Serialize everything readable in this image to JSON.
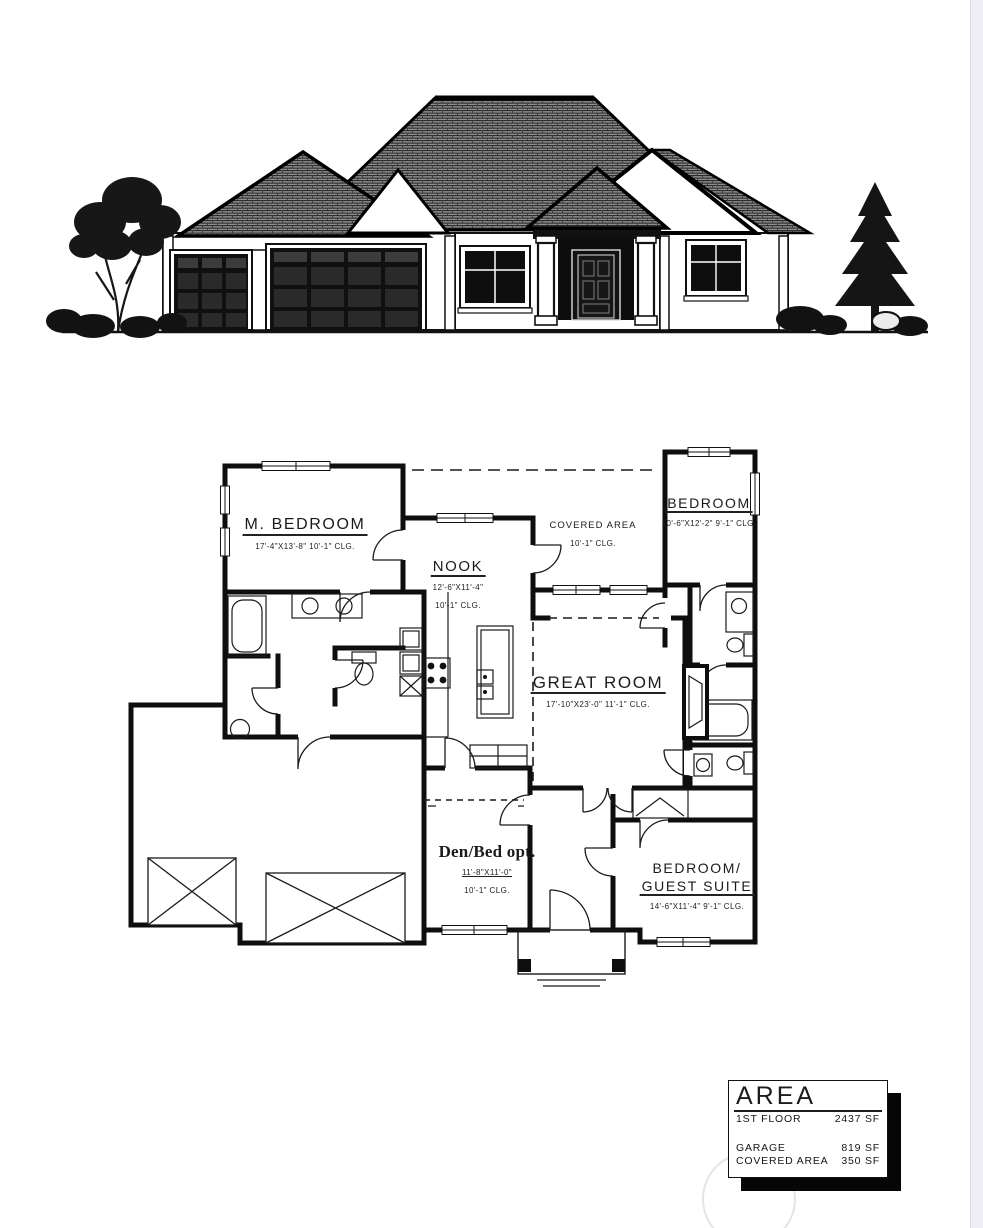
{
  "floor_plan": {
    "rooms": {
      "m_bedroom": {
        "name": "M. BEDROOM",
        "line2": "17'-4\"X13'-8\"   10'-1\" CLG."
      },
      "nook": {
        "name": "NOOK",
        "line2": "12'-6\"X11'-4\"",
        "line3": "10'-1\" CLG."
      },
      "covered_area": {
        "name": "COVERED AREA",
        "line2": "10'-1\" CLG."
      },
      "bedroom": {
        "name": "BEDROOM",
        "line2": "10'-6\"X12'-2\"  9'-1\" CLG."
      },
      "great_room": {
        "name": "GREAT ROOM",
        "line2": "17'-10\"X23'-0\"   11'-1\" CLG."
      },
      "den": {
        "name": "Den/Bed opt.",
        "line2": "11'-8\"X11'-0\"",
        "line3": "10'-1\" CLG."
      },
      "guest_suite": {
        "name": "BEDROOM/",
        "name2": "GUEST SUITE",
        "line2": "14'-6\"X11'-4\"      9'-1\" CLG."
      }
    }
  },
  "area_table": {
    "title": "AREA",
    "rows": [
      {
        "label": "1ST FLOOR",
        "value": "2437 SF"
      },
      {
        "label": "GARAGE",
        "value": "819 SF"
      },
      {
        "label": "COVERED AREA",
        "value": "350 SF"
      }
    ]
  }
}
